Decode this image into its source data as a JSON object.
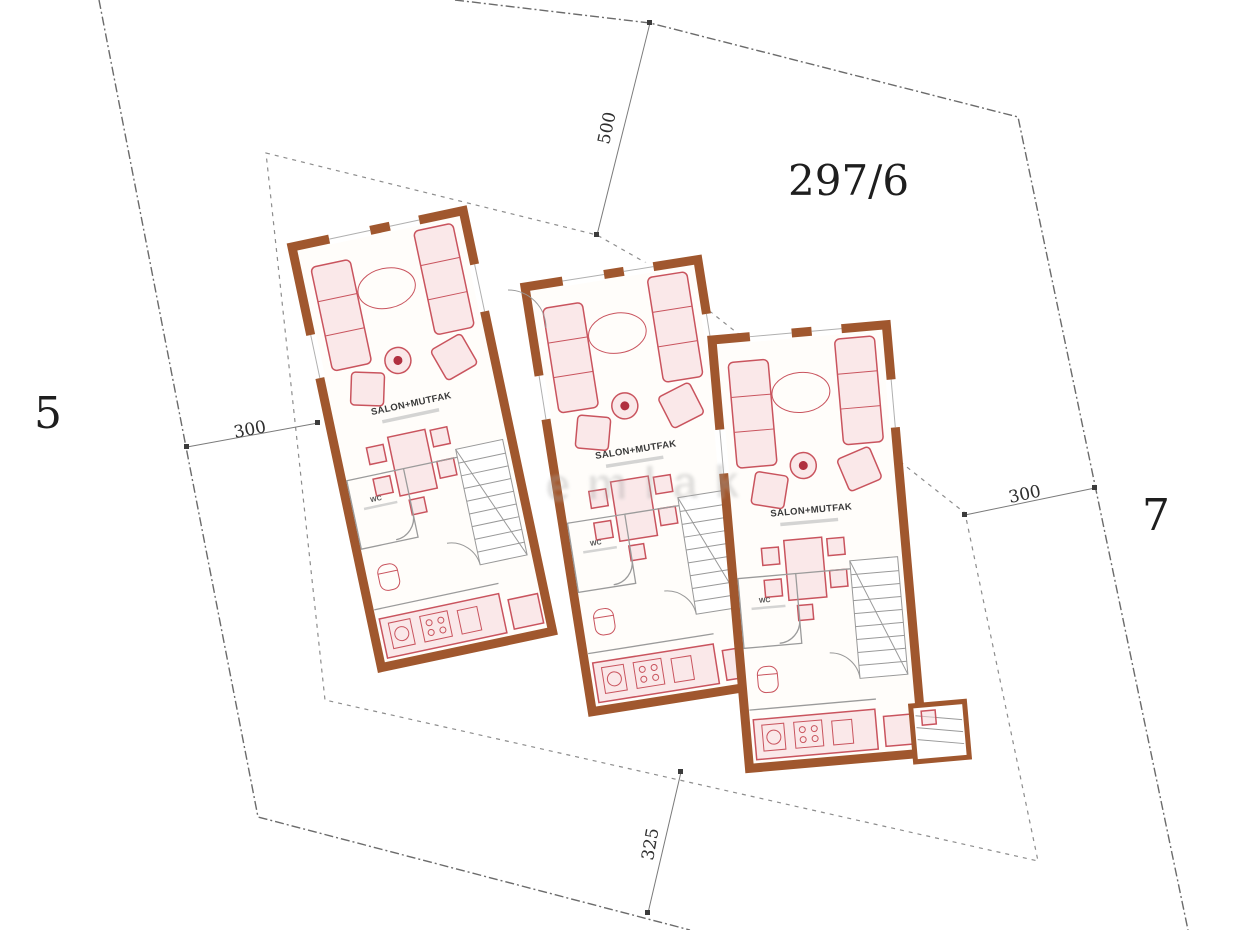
{
  "plan": {
    "parcel_label": "297/6",
    "neighbor_plots": {
      "left": "5",
      "right": "7"
    },
    "dimensions": {
      "top": "500",
      "left": "300",
      "right": "300",
      "bottom": "325"
    },
    "units": [
      {
        "name": "unit-1",
        "room_label": "SALON+MUTFAK",
        "wc_label": "WC"
      },
      {
        "name": "unit-2",
        "room_label": "SALON+MUTFAK",
        "wc_label": "WC"
      },
      {
        "name": "unit-3",
        "room_label": "SALON+MUTFAK",
        "wc_label": "WC"
      }
    ],
    "watermark": "emlak",
    "colors": {
      "wall": "#a0572e",
      "furniture_stroke": "#c9545e",
      "furniture_fill": "#f6d7da",
      "boundary": "#6b6b6b",
      "setback": "#8d8d8d",
      "interior_line": "#9b9b9b",
      "room_label_text": "#3a3a3a",
      "plot_text": "#1e1e1e"
    }
  }
}
